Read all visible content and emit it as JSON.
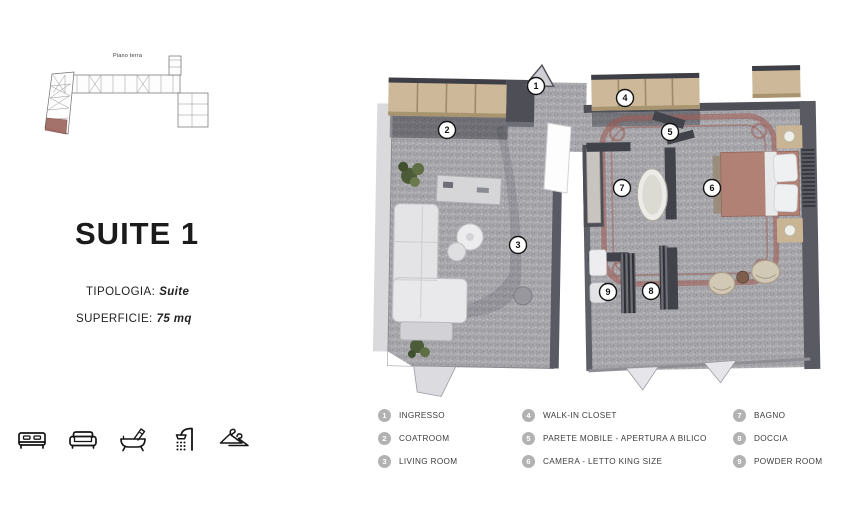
{
  "overview": {
    "title": "Piano terra"
  },
  "info": {
    "title": "SUITE 1",
    "tipologia": {
      "label": "TIPOLOGIA:",
      "value": "Suite"
    },
    "superficie": {
      "label": "SUPERFICIE:",
      "value": "75 mq"
    }
  },
  "amenities": {
    "icons": [
      "bed-icon",
      "sofa-icon",
      "bathtub-icon",
      "shower-icon",
      "hanger-icon"
    ]
  },
  "plan": {
    "markers": [
      {
        "n": "1"
      },
      {
        "n": "2"
      },
      {
        "n": "3"
      },
      {
        "n": "4"
      },
      {
        "n": "5"
      },
      {
        "n": "6"
      },
      {
        "n": "7"
      },
      {
        "n": "8"
      },
      {
        "n": "9"
      }
    ]
  },
  "legend": {
    "items": [
      {
        "num": "1",
        "label": "INGRESSO"
      },
      {
        "num": "2",
        "label": "COATROOM"
      },
      {
        "num": "3",
        "label": "LIVING ROOM"
      },
      {
        "num": "4",
        "label": "WALK-IN CLOSET"
      },
      {
        "num": "5",
        "label": "PARETE MOBILE -  APERTURA A BILICO"
      },
      {
        "num": "6",
        "label": "CAMERA - LETTO KING SIZE"
      },
      {
        "num": "7",
        "label": "BAGNO"
      },
      {
        "num": "8",
        "label": "DOCCIA"
      },
      {
        "num": "9",
        "label": "POWDER ROOM"
      }
    ]
  },
  "colors": {
    "floor_gray": "#a4a4a9",
    "wall_dark": "#4e4e57",
    "cabinet_tan": "#cdb999",
    "terracotta_border": "#9e564d",
    "bed_mauve": "#b08174",
    "legend_circle": "#b2b2b2",
    "thumb_highlight": "#9b635c"
  }
}
